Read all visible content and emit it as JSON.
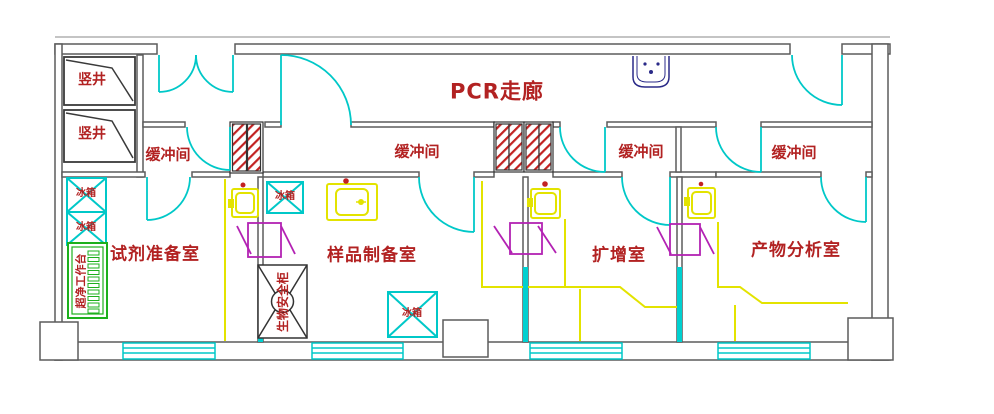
{
  "drawing": {
    "title": "PCR走廊",
    "kind": "PCR laboratory floor plan"
  },
  "labels": {
    "corridor": "PCR走廊",
    "shaft_1": "竖井",
    "shaft_2": "竖井",
    "buffer_1": "缓冲间",
    "buffer_2": "缓冲间",
    "buffer_3": "缓冲间",
    "buffer_4": "缓冲间",
    "room_reagent": "试剂准备室",
    "room_sample": "样品制备室",
    "room_amplification": "扩增室",
    "room_product": "产物分析室",
    "fridge_1": "冰箱",
    "fridge_2": "冰箱",
    "fridge_3": "冰箱",
    "fridge_4": "冰箱",
    "clean_bench": "超净工作台",
    "biosafety_cabinet": "生物安全柜"
  },
  "colors": {
    "wall_gray": "#5c5c5c",
    "detail_black": "#333333",
    "door_glass_cyan": "#00d0d0",
    "bench_yellow": "#f0f000",
    "pass_box_magenta": "#b322b3",
    "transfer_hatch_red": "#c22222",
    "label_red": "#b22222",
    "clean_bench_green": "#1db01d",
    "corridor_sink_navy": "#2a2a88",
    "background": "#ffffff"
  }
}
